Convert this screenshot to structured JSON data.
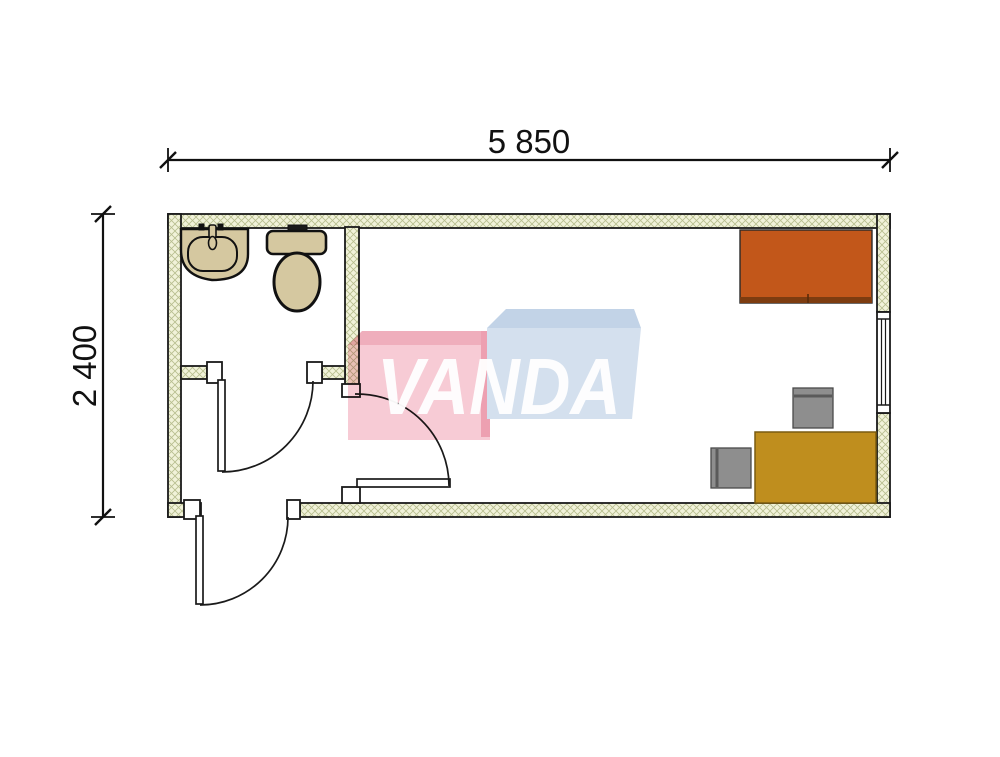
{
  "dimensions": {
    "width_label": "5 850",
    "height_label": "2 400"
  },
  "watermark": {
    "text": "VANDA",
    "text_color": "#ffffff",
    "pink_front": "#f7cbd5",
    "pink_top": "#efaebc",
    "pink_side": "#eda0b1",
    "blue_front": "#d4e0ee",
    "blue_top": "#c2d3e7"
  },
  "plan": {
    "colors": {
      "wall_fill": "#f1f2d9",
      "wall_hatch": "#b7bd8e",
      "line": "#1a1a1a",
      "fixture_fill": "#d5c8a0",
      "cabinet_fill": "#c2571a",
      "cabinet_edge": "#7d3c10",
      "desk_fill": "#bf8e1e",
      "chair_fill": "#8e8e8e",
      "chair_back": "#5a5a5a"
    },
    "objects": {
      "overall_width_mm": "5 850",
      "overall_depth_mm": "2 400",
      "rooms": [
        "bathroom",
        "entry-hall",
        "office"
      ],
      "bathroom_fixtures": [
        "washbasin",
        "toilet"
      ],
      "doors": [
        "exterior-entrance-door",
        "bathroom-door",
        "office-door"
      ],
      "windows": 1,
      "furniture": [
        "cabinet",
        "desk",
        "chair",
        "chair"
      ]
    }
  }
}
